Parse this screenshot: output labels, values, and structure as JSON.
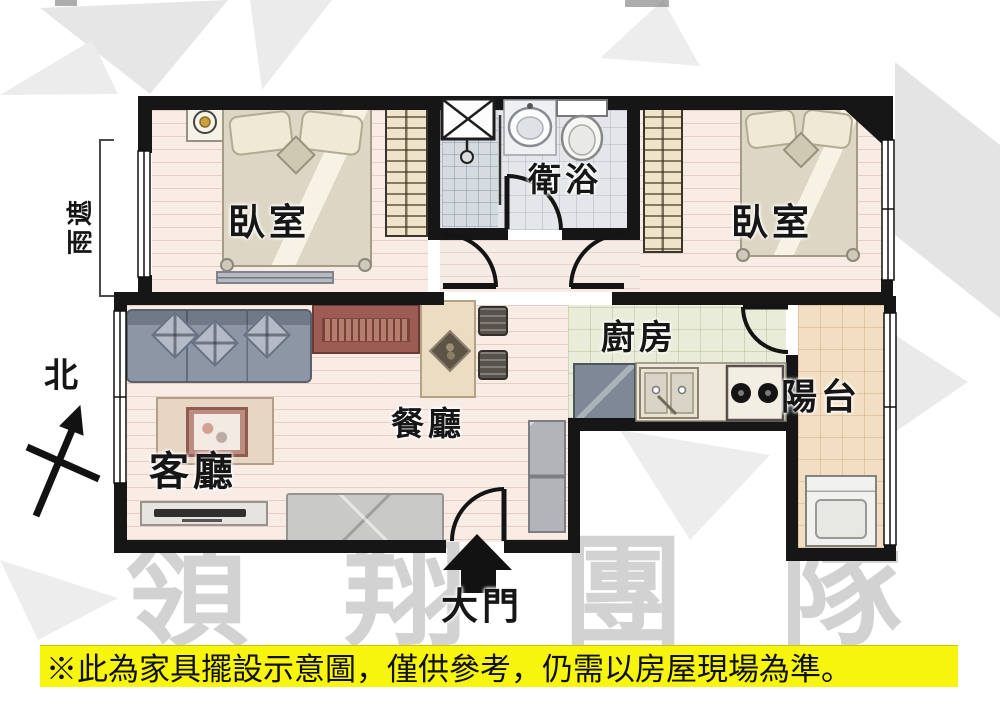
{
  "rooms": {
    "bedroom_left": {
      "label": "臥室"
    },
    "bedroom_right": {
      "label": "臥室"
    },
    "bathroom": {
      "label": "衛浴"
    },
    "kitchen": {
      "label": "廚房"
    },
    "balcony": {
      "label": "陽台"
    },
    "dining": {
      "label": "餐廳"
    },
    "living": {
      "label": "客廳"
    }
  },
  "annotations": {
    "main_door": "大門",
    "north": "北",
    "rain_shelter": "雨遮"
  },
  "watermark": {
    "text": "領翔團隊"
  },
  "disclaimer": {
    "text": "※此為家具擺設示意圖，僅供參考，仍需以房屋現場為準。"
  },
  "colors": {
    "wall": "#161616",
    "banner_bg": "#f7f50e",
    "watermark_gray": "#d2d2d2",
    "sideboard_red": "#9c5c53",
    "sofa_blue_gray": "#8d96a5"
  }
}
